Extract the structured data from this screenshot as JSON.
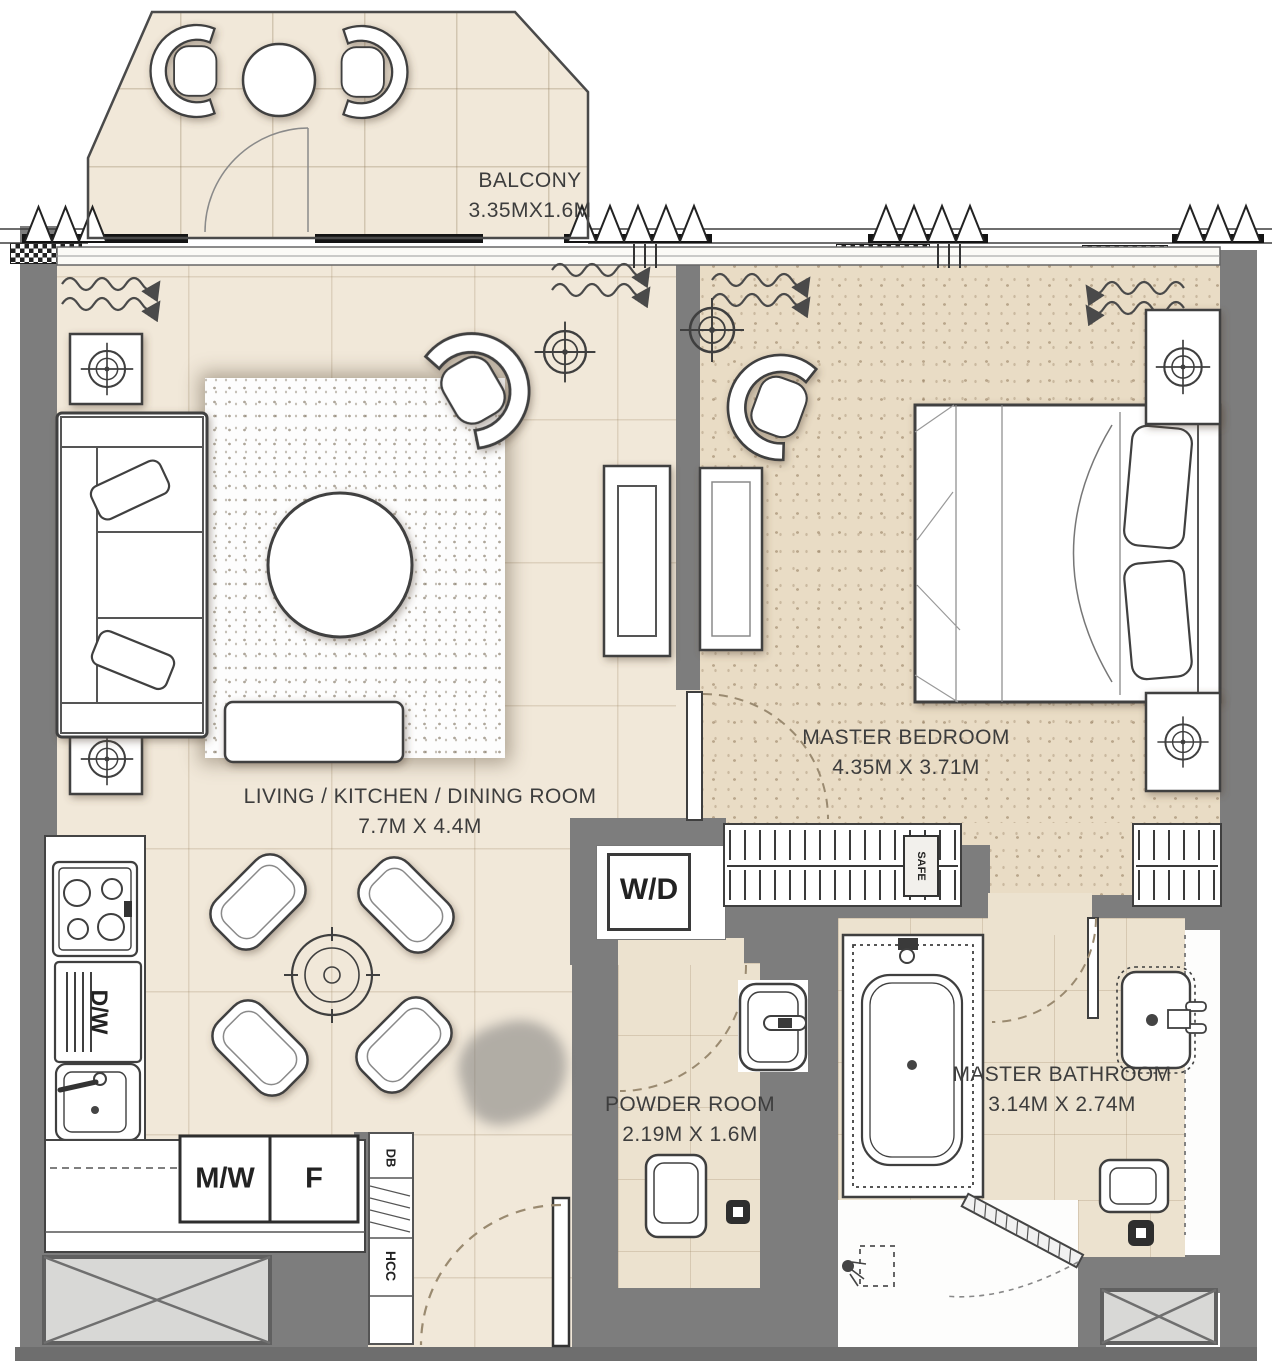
{
  "rooms": {
    "balcony": {
      "name": "BALCONY",
      "dims": "3.35MX1.6M"
    },
    "living": {
      "name": "LIVING / KITCHEN / DINING ROOM",
      "dims": "7.7M X 4.4M"
    },
    "bedroom": {
      "name": "MASTER BEDROOM",
      "dims": "4.35M X 3.71M"
    },
    "powder": {
      "name": "POWDER ROOM",
      "dims": "2.19M X 1.6M"
    },
    "bathroom": {
      "name": "MASTER BATHROOM",
      "dims": "3.14M X 2.74M"
    }
  },
  "labels": {
    "washer_dryer": "W/D",
    "microwave": "M/W",
    "fridge": "F",
    "dishwasher": "D/W",
    "db": "DB",
    "hcc": "HCC",
    "safe": "SAFE"
  },
  "colors": {
    "wall": "#7d7d7d",
    "floor_living": "#f1e8d9",
    "floor_bedroom": "#e9dcc5",
    "floor_wet": "#ece2cf",
    "fixture_outline": "#3f3f3f",
    "door_swing_dash": "#9a8a70"
  }
}
